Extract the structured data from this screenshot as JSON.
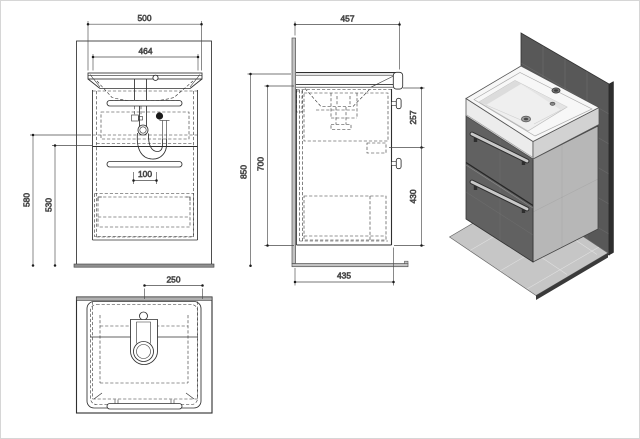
{
  "dims": {
    "front": {
      "overall_width": "500",
      "basin_width": "464",
      "height_outer": "580",
      "height_inner": "530",
      "trap_offset": "100"
    },
    "plan": {
      "faucet_to_edge": "250"
    },
    "side": {
      "depth": "457",
      "total_height": "850",
      "cabinet_height": "700",
      "upper_section": "257",
      "lower_section": "430",
      "floor_depth": "435"
    }
  },
  "colors": {
    "panel_face": "#585858",
    "panel_edge": "#2e2e2e",
    "floor_plate": "#c6c6c6",
    "floor_edge": "#3a3a3a",
    "cabinet_front": "#616161",
    "cabinet_side": "#b7b7b7",
    "sink_top": "#f7f7f7",
    "sink_rim_left": "#ececec",
    "sink_rim_right": "#d2d2d2",
    "handle": "#c9c9c9"
  }
}
